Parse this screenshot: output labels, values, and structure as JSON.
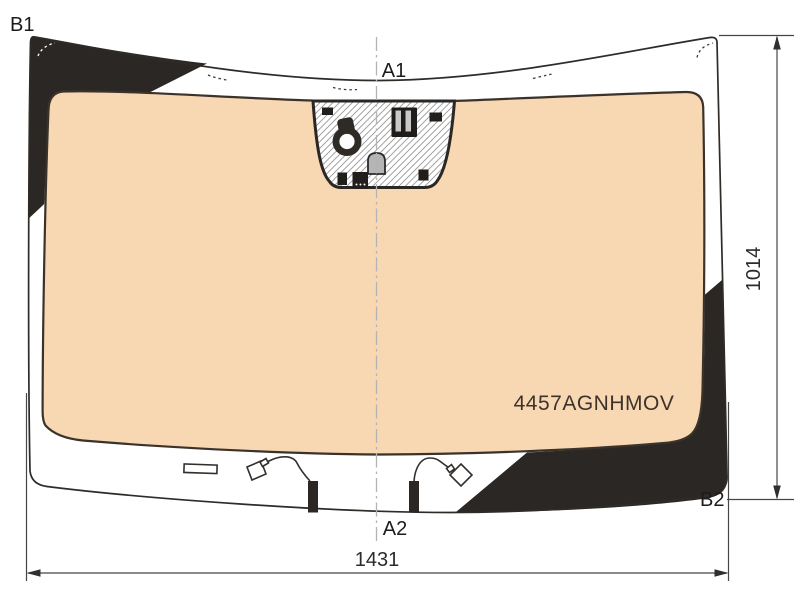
{
  "diagram_type": "windshield-glass-technical-drawing",
  "part_number": "4457AGNHMOV",
  "corner_labels": {
    "top_left": "B1",
    "top_center": "A1",
    "bottom_center": "A2",
    "bottom_right": "B2"
  },
  "dimensions": {
    "width_mm": "1431",
    "height_mm": "1014"
  },
  "colors": {
    "glass": "#f8d7b3",
    "ceramic_band": "#2b2724",
    "outline": "#2f2b27",
    "hatch": "#999999",
    "bracket_body": "#1f1c19",
    "bracket_slot": "#c9c9c9",
    "dome": "#b5b5b5",
    "sensor": "#2e2a26"
  },
  "sensor_area_components": [
    "rain-sensor-icon",
    "camera-bracket-icon",
    "mirror-mount-dome-icon",
    "mounting-pad-icon"
  ]
}
